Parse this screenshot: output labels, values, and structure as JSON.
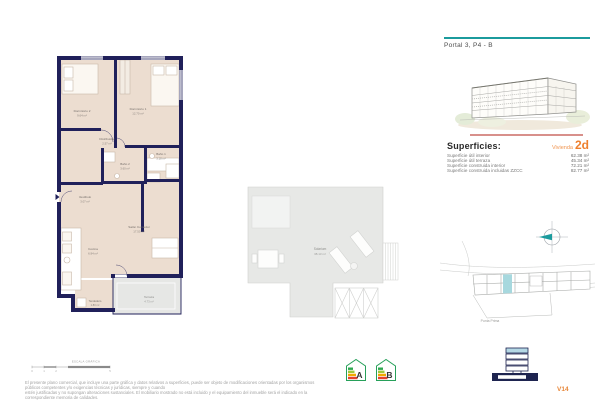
{
  "header": {
    "title": "Portal 3, P4 - B"
  },
  "superficies": {
    "heading": "Superficies:",
    "vivienda_label": "Vivienda",
    "vivienda_type": "2d",
    "rows": [
      {
        "label": "Superficie útil interior",
        "value": "62.38 m²"
      },
      {
        "label": "Superficie útil terraza",
        "value": "45.34 m²"
      },
      {
        "label": "Superficie construida interior",
        "value": "72.21 m²"
      },
      {
        "label": "Superficie construida incluidas ZZCC",
        "value": "82.77 m²"
      }
    ]
  },
  "floorplan": {
    "rooms": {
      "dormitorio2": {
        "name": "Dormitorio 2",
        "area": "9.64 m²"
      },
      "dormitorio1": {
        "name": "Dormitorio 1",
        "area": "12.70 m²"
      },
      "distribuidor": {
        "name": "Distribuidor",
        "area": "2.57 m²"
      },
      "bano1": {
        "name": "Baño 1",
        "area": "3.18 m²"
      },
      "bano2": {
        "name": "Baño 2",
        "area": "3.60 m²"
      },
      "vestibulo": {
        "name": "Vestíbulo",
        "area": "3.07 m²"
      },
      "salon": {
        "name": "Salón Comedor",
        "area": "17.50 m²"
      },
      "cocina": {
        "name": "Cocina",
        "area": "6.94 m²"
      },
      "tendedero": {
        "name": "Tendedero",
        "area": "1.80 m²"
      },
      "terraza": {
        "name": "Terraza",
        "area": "4.73 m²"
      }
    }
  },
  "solarium": {
    "name": "Solarium",
    "area": "38.13 m²"
  },
  "site": {
    "label": "Punta Prima"
  },
  "energy": {
    "a": "A",
    "b": "B"
  },
  "scale": {
    "label": "ESCALA GRÁFICA",
    "ticks": [
      "0",
      "1",
      "2",
      "5"
    ]
  },
  "footer": {
    "disclaimer_line1": "El presente plano comercial, que incluye una parte gráfica y datos relativos a superficies, puede ser objeto de modificaciones orientadas por los organismos públicos competentes y/o exigencias técnicas y jurídicas, siempre y cuando",
    "disclaimer_line2": "estén justificadas y no supongan alteraciones sustanciales. El mobiliario mostrado no está incluido y el equipamiento del inmueble será el indicado en la correspondiente memoria de calidades.",
    "version": "V14"
  },
  "colors": {
    "accent_teal": "#1b9b9d",
    "accent_orange": "#ee7f2d",
    "wall_navy": "#20205a",
    "floor_beige": "#ecddd0",
    "terrace_gray": "#e6e7e5",
    "site_highlight": "#a7d8de"
  }
}
